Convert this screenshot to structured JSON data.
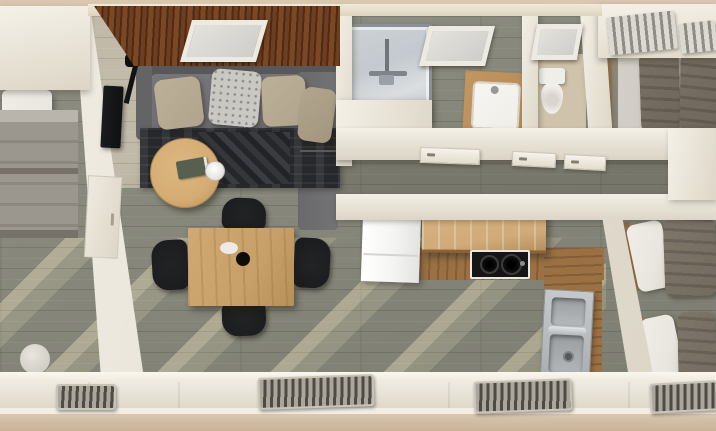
{
  "scene": {
    "kind": "3d-floorplan-top-down-render",
    "description": "Overhead 3D render of a small apartment / tiny home interior",
    "width_px": 716,
    "height_px": 431
  },
  "palette": {
    "wall-light": "#f2eee5",
    "wall-mid": "#e6e0d3",
    "wall-shade": "#d3ccbd",
    "trim-beige": "#d9c7b0",
    "trim-beige-dark": "#c9b298",
    "floor-olive": "#8e8f82",
    "floor-olive-dark": "#7c7d70",
    "floor-living": "#c1baa9",
    "sun-stripe": "#ece0c2",
    "wood-ceiling-dark": "#55290f",
    "wood-ceiling-mid": "#6c3e22",
    "wood-ceiling-light": "#7b4827",
    "sofa-gray": "#6f6f71",
    "sofa-gray-dark": "#58585a",
    "pillow-tan": "#b0a48d",
    "pillow-light": "#cac8c3",
    "pillow-white": "#e9e6df",
    "rug-dark": "#27282b",
    "rug-pattern": "#3a3d42",
    "oak-light": "#d5ac74",
    "oak-mid": "#c79f68",
    "chair-black": "#1a1b1d",
    "lamp-black": "#111214",
    "tv-black": "#101113",
    "book-green": "#57604f",
    "fridge-white": "#f4f4f2",
    "shelf-oak": "#d0ab79",
    "counter-wood": "#9b7144",
    "cooktop-black": "#151515",
    "steel-light": "#c6c9cb",
    "steel-mid": "#a9adaf",
    "steel-dark": "#8f9395",
    "shower-glass": "#c3c9ce",
    "chrome": "#8a9095",
    "vanity-wood": "#b5895a",
    "porcelain": "#f0eee9",
    "wc-floor": "#cfc3ab",
    "bedroom-wood-floor": "#9c7a50",
    "mattress-light": "#c9c5be",
    "duvet-taupe": "#6f675c",
    "duvet-taupe-2": "#746b5f",
    "blanket-gray": "#9c978e",
    "headboard-gray": "#8d877b",
    "bed-frame-wood": "#8a6a48",
    "radiator-base": "#c9c4b8",
    "radiator-fin-light": "#aaa69c",
    "radiator-fin-dark": "#4e4b44"
  },
  "rooms": [
    {
      "id": "bedroom-left",
      "furniture": [
        "single-bed",
        "pillow",
        "gray-blanket",
        "round-pouf"
      ]
    },
    {
      "id": "living-room",
      "furniture": [
        "wood-plank-ceiling-accent",
        "skylight",
        "gray-sofa-with-chaise",
        "throw-pillow-tan",
        "throw-pillow-patterned",
        "throw-pillow-tan",
        "throw-pillow-tan",
        "floor-lamp",
        "dark-patterned-rug",
        "round-oak-coffee-table",
        "green-book",
        "white-cup",
        "wall-tv",
        "wall-cabinet"
      ]
    },
    {
      "id": "dining-area",
      "furniture": [
        "oak-dining-table",
        "black-chair-top",
        "black-chair-bottom",
        "black-chair-left",
        "black-chair-right",
        "dark-vase",
        "white-plate"
      ]
    },
    {
      "id": "bathroom",
      "furniture": [
        "walk-in-shower",
        "chrome-shower-fixture",
        "skylight",
        "wood-vanity-with-white-sink"
      ]
    },
    {
      "id": "wc",
      "furniture": [
        "toilet",
        "skylight"
      ]
    },
    {
      "id": "hallway",
      "furniture": [
        "door",
        "door",
        "door"
      ]
    },
    {
      "id": "kitchen",
      "furniture": [
        "white-fridge",
        "oak-wall-shelf",
        "wood-countertop-l-shaped",
        "black-two-burner-cooktop",
        "stainless-double-sink"
      ]
    },
    {
      "id": "bedroom-top-right",
      "furniture": [
        "double-bed",
        "taupe-duvets",
        "slatted-window-blinds",
        "slatted-window-blinds"
      ]
    },
    {
      "id": "bedroom-bottom-right",
      "furniture": [
        "twin-bed",
        "twin-bed",
        "white-pillows",
        "taupe-duvets",
        "radiator"
      ]
    }
  ],
  "counts": {
    "skylights": 3,
    "dining_chairs": 4,
    "sofa_pillows": 4,
    "radiators_bottom_wall": 4,
    "beds_total": 4,
    "doors_visible": 3
  }
}
